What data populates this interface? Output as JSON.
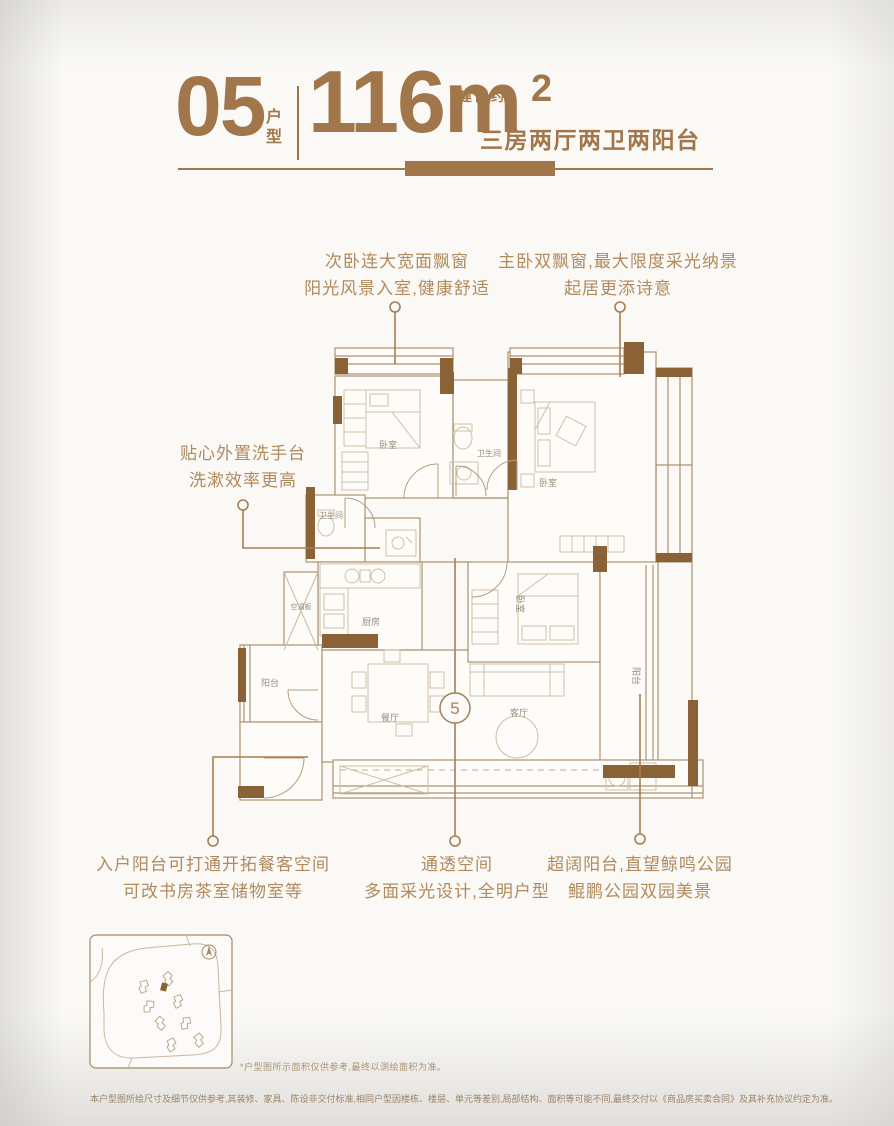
{
  "header": {
    "unit_number": "05",
    "unit_type_label": "户型",
    "area_prefix": "建面约",
    "area_value": "116m",
    "area_exponent": "2",
    "layout_desc": "三房两厅两卫两阳台"
  },
  "callouts": {
    "top_left": {
      "line1": "次卧连大宽面飘窗",
      "line2": "阳光风景入室,健康舒适"
    },
    "top_right": {
      "line1": "主卧双飘窗,最大限度采光纳景",
      "line2": "起居更添诗意"
    },
    "mid_left": {
      "line1": "贴心外置洗手台",
      "line2": "洗漱效率更高"
    },
    "bottom_left": {
      "line1": "入户阳台可打通开拓餐客空间",
      "line2": "可改书房茶室储物室等"
    },
    "bottom_center": {
      "line1": "通透空间",
      "line2": "多面采光设计,全明户型"
    },
    "bottom_right": {
      "line1": "超阔阳台,直望鲸鸣公园",
      "line2": "鲲鹏公园双园美景"
    }
  },
  "plan": {
    "unit_circle_number": "5",
    "rooms": {
      "secondary_bedroom": "卧室",
      "bathroom_top": "卫生间",
      "master_bedroom": "卧室",
      "bathroom_mid": "卫生间",
      "kitchen": "厨房",
      "ac_panel": "空调板",
      "balcony_left": "阳台",
      "dining": "餐厅",
      "bedroom_third": "卧室",
      "living": "客厅",
      "balcony_right": "阳台"
    }
  },
  "footnotes": {
    "sitemap_note": "*户型图所示面积仅供参考,最终以测绘面积为准。",
    "disclaimer": "本户型图所绘尺寸及细节仅供参考,其装修、家具、陈设非交付标准,相同户型因楼栋、楼层、单元等差别,局部结构、面积等可能不同,最终交付以《商品房买卖合同》及其补充协议约定为准。"
  },
  "colors": {
    "brand_brown": "#a1764a",
    "callout_brown": "#b18a5e",
    "wall_solid_brown": "#8a6236",
    "plan_line": "#ab9273"
  }
}
